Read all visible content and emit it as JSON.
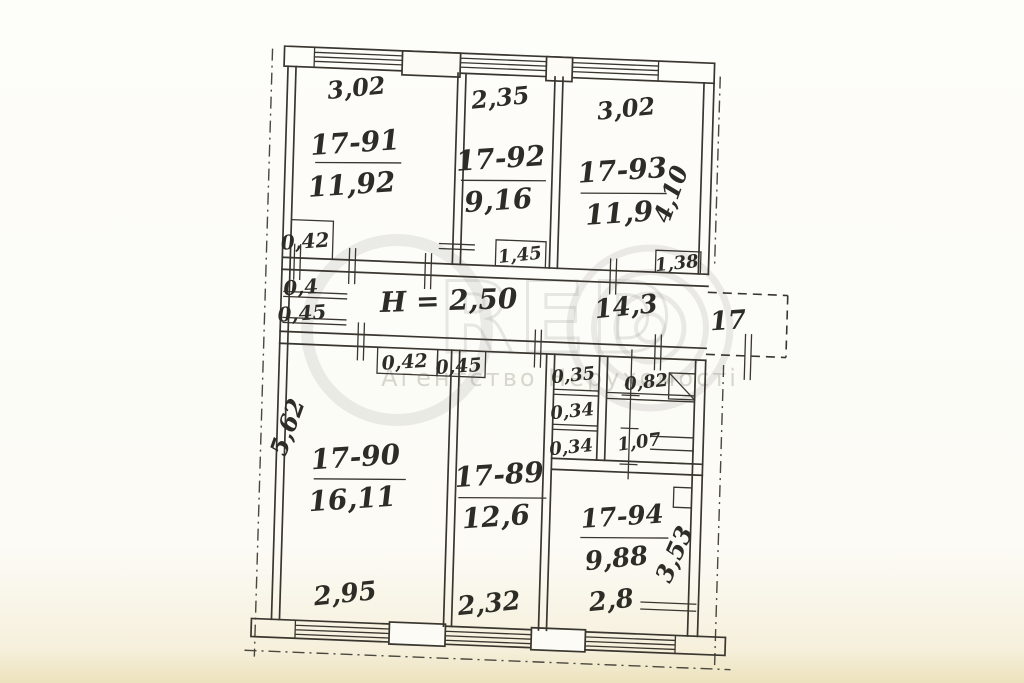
{
  "watermark": {
    "letters_mid": "RED",
    "subtitle": "Агентство Нерухомості"
  },
  "corridor": {
    "ceiling_height": "H = 2,50",
    "length": "14,3",
    "label_right": "17"
  },
  "rooms": [
    {
      "number": "17-91",
      "area": "11,92",
      "width": "3,02"
    },
    {
      "number": "17-92",
      "area": "9,16",
      "width": "2,35"
    },
    {
      "number": "17-93",
      "area": "11,9",
      "width": "3,02",
      "height": "4,10"
    },
    {
      "number": "17-90",
      "area": "16,11",
      "width": "2,95",
      "height": "5,62"
    },
    {
      "number": "17-89",
      "area": "12,6",
      "width": "2,32"
    },
    {
      "number": "17-94",
      "area": "9,88",
      "width": "2,8",
      "height": "3,53"
    }
  ],
  "wall_dims": {
    "left_stack": [
      "0,42",
      "0,4",
      "0,45"
    ],
    "below_corridor": [
      "0,42",
      "0,45"
    ],
    "niche_center": "1,45",
    "niche_right": "1,38",
    "cell_stack": [
      "0,35",
      "0,34",
      "0,34"
    ],
    "shaft_upper": "0,82",
    "shaft_lower": "1,07"
  }
}
